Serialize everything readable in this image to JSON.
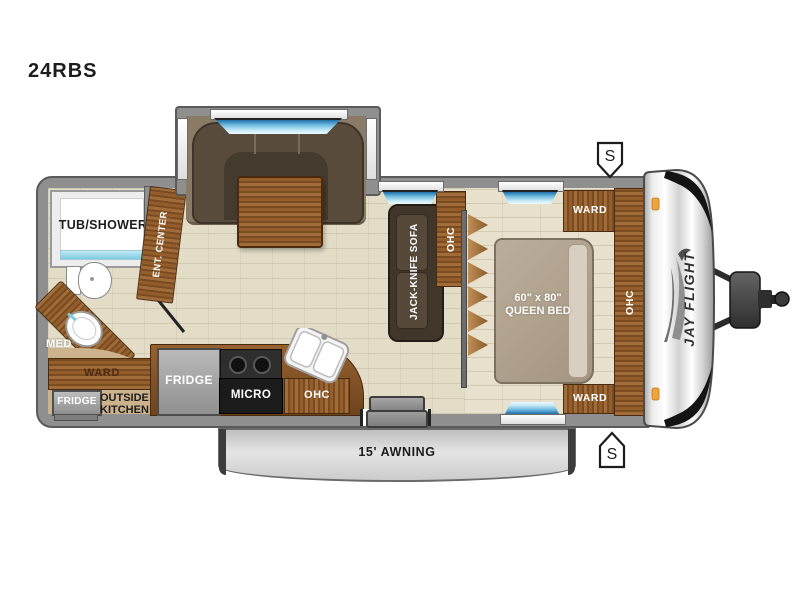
{
  "title": "24RBS",
  "colors": {
    "wood": "#8a5a2e",
    "wall_gray": "#8f8f8f",
    "window_glass": "#6db9df",
    "floor_beige": "#e3dcc7",
    "marker_orange": "#f0a43c",
    "awning_gray": "#d4d4d4"
  },
  "bathroom": {
    "tub_label": "TUB/SHOWER",
    "med_label": "MED",
    "ward_label": "WARD",
    "fridge_label": "FRIDGE",
    "outside_kitchen_line1": "OUTSIDE",
    "outside_kitchen_line2": "KITCHEN"
  },
  "living": {
    "ent_center_label": "ENT. CENTER",
    "sofa_label": "JACK-KNIFE SOFA",
    "sofa_ohc_label": "OHC"
  },
  "kitchen": {
    "fridge_label": "FRIDGE",
    "micro_label": "MICRO",
    "ohc_label": "OHC"
  },
  "bedroom": {
    "bed_size_label": "60\" x 80\"",
    "bed_type_label": "QUEEN BED",
    "ward_top_label": "WARD",
    "ward_bottom_label": "WARD",
    "ohc_label": "OHC"
  },
  "exterior": {
    "awning_label": "15' AWNING",
    "brand_logo": "JAY FLIGHT",
    "stab_jack_top": "S",
    "stab_jack_bottom": "S"
  }
}
